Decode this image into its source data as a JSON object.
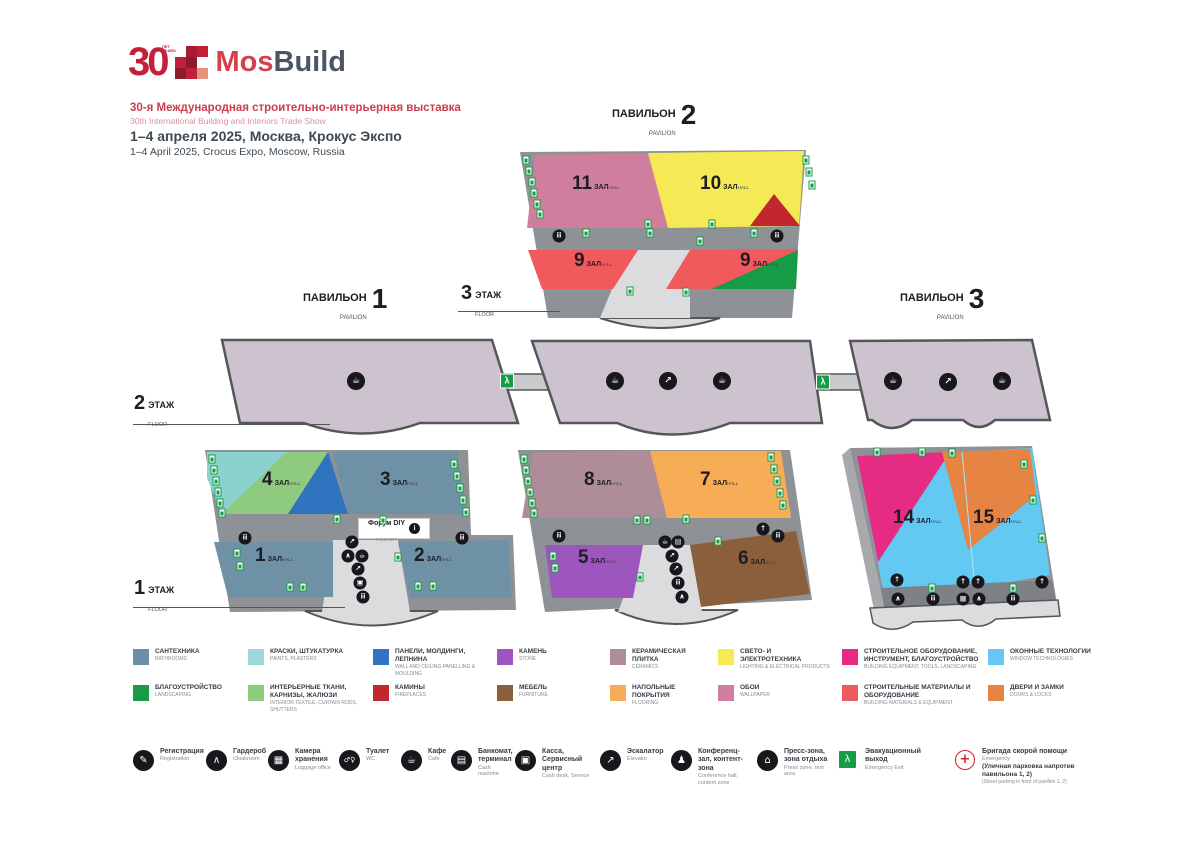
{
  "header": {
    "logo_number": "30",
    "logo_years_ru": "ЛЕТ",
    "logo_years_en": "YEARS",
    "brand_mos": "Mos",
    "brand_build": "Build",
    "title_ru": "30-я Международная строительно-интерьерная выставка",
    "title_en": "30th International Building and Interiors Trade Show",
    "date_ru": "1–4 апреля 2025, Москва, Крокус Экспо",
    "date_en": "1–4 April 2025, Crocus Expo, Moscow, Russia",
    "logo_mosaic": [
      "",
      "#A81D34",
      "#C22038",
      "#C22038",
      "#8E1B2D",
      "#FFFFFF",
      "#8E1B2D",
      "#C22038",
      "#E8927E"
    ]
  },
  "words": {
    "pavilion_ru": "ПАВИЛЬОН",
    "pavilion_en": "PAVILION",
    "floor_ru": "ЭТАЖ",
    "floor_en": "FLOOR"
  },
  "pavilions": {
    "p1": "1",
    "p2": "2",
    "p3": "3"
  },
  "floors": {
    "f1": "1",
    "f2": "2",
    "f3": "3"
  },
  "labels": {
    "zal": "ЗАЛ",
    "hall": "HALL"
  },
  "halls": {
    "h1": "1",
    "h2": "2",
    "h3": "3",
    "h4": "4",
    "h5": "5",
    "h6": "6",
    "h7": "7",
    "h8": "8",
    "h9": "9",
    "h10": "10",
    "h11": "11",
    "h14": "14",
    "h15": "15"
  },
  "forum": {
    "ru": "Форум DIY",
    "en": "Forum DIY"
  },
  "legend": [
    {
      "ru": "САНТЕХНИКА",
      "en": "BATHROOMS",
      "color": "#6D8FA3"
    },
    {
      "ru": "БЛАГОУСТРОЙСТВО",
      "en": "LANDSCAPING",
      "color": "#169C46"
    },
    {
      "ru": "КРАСКИ, ШТУКАТУРКА",
      "en": "PAINTS, PLASTERS",
      "color": "#9FD9D7"
    },
    {
      "ru": "ИНТЕРЬЕРНЫЕ ТКАНИ, КАРНИЗЫ, ЖАЛЮЗИ",
      "en": "INTERIOR TEXTILE, CURTAIN RODS, SHUTTERS",
      "color": "#8FCB7E"
    },
    {
      "ru": "ПАНЕЛИ, МОЛДИНГИ, ЛЕПНИНА",
      "en": "WALL AND CEILING PANELLING & MOULDING",
      "color": "#2E74BE"
    },
    {
      "ru": "КАМИНЫ",
      "en": "FIREPLACES",
      "color": "#C1272D"
    },
    {
      "ru": "КАМЕНЬ",
      "en": "STONE",
      "color": "#9D56BE"
    },
    {
      "ru": "МЕБЕЛЬ",
      "en": "FURNITURE",
      "color": "#8C5F3C"
    },
    {
      "ru": "КЕРАМИЧЕСКАЯ ПЛИТКА",
      "en": "CERAMICS",
      "color": "#AE8D98"
    },
    {
      "ru": "НАПОЛЬНЫЕ ПОКРЫТИЯ",
      "en": "FLOORING",
      "color": "#F7AC56"
    },
    {
      "ru": "СВЕТО- И ЭЛЕКТРОТЕХНИКА",
      "en": "LIGHTING & ELECTRICAL PRODUCTS",
      "color": "#F5EA55"
    },
    {
      "ru": "ОБОИ",
      "en": "WALLPAPER",
      "color": "#CF7F9D"
    },
    {
      "ru": "СТРОИТЕЛЬНОЕ ОБОРУДОВАНИЕ, ИНСТРУМЕНТ, БЛАГОУСТРОЙСТВО",
      "en": "BUILDING EQUIPMENT, TOOLS, LANDSCAPING",
      "color": "#E62B82"
    },
    {
      "ru": "СТРОИТЕЛЬНЫЕ МАТЕРИАЛЫ И ОБОРУДОВАНИЕ",
      "en": "BUILDING MATERIALS & EQUIPMENT",
      "color": "#F05A5C"
    },
    {
      "ru": "ОКОННЫЕ ТЕХНОЛОГИИ",
      "en": "WINDOW TECHNOLOGIES",
      "color": "#63C8F2"
    },
    {
      "ru": "ДВЕРИ И ЗАМКИ",
      "en": "DOORS & LOCKS",
      "color": "#E58443"
    }
  ],
  "services": [
    {
      "ru": "Регистрация",
      "en": "Registration"
    },
    {
      "ru": "Гардероб",
      "en": "Cloakroom"
    },
    {
      "ru": "Камера хранения",
      "en": "Luggage office"
    },
    {
      "ru": "Туалет",
      "en": "WC"
    },
    {
      "ru": "Кафе",
      "en": "Cafe"
    },
    {
      "ru": "Банкомат, терминал",
      "en": "Cash machine"
    },
    {
      "ru": "Касса, Сервисный центр",
      "en": "Cash desk, Service"
    },
    {
      "ru": "Эскалатор",
      "en": "Elevator"
    },
    {
      "ru": "Конференц-зал, контент-зона",
      "en": "Conference hall, content zone"
    },
    {
      "ru": "Пресс-зона, зона отдыха",
      "en": "Press zone, rest area"
    },
    {
      "ru": "Эвакуационный выход",
      "en": "Emergency Exit"
    },
    {
      "ru": "Бригада скорой помощи",
      "en": "Emergency",
      "extra_ru": "(Уличная парковка напротив павильона 1, 2)",
      "extra_en": "(Street parking in front of pavilion 1, 2)"
    }
  ],
  "glyphs": {
    "toilet": "ii",
    "cafe": "☕",
    "escalator": "↗",
    "up": "↑",
    "atm": "▤",
    "luggage": "▦",
    "cloakroom": "∧",
    "cash": "▣",
    "info": "i",
    "wc": "♂♀",
    "registration": "✎",
    "conference": "♟",
    "rest": "⌂",
    "exit": "λ",
    "aid": "+"
  }
}
